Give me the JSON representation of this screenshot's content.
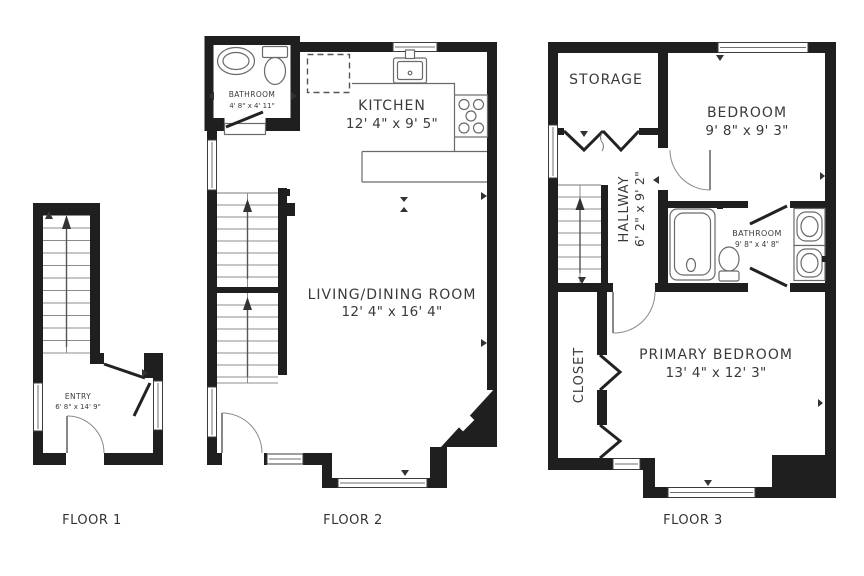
{
  "palette": {
    "wall": "#1f1f1f",
    "fixture_line": "#6a6a6a",
    "stair_line": "#8c8c8c",
    "text": "#3a3a3a",
    "background": "#ffffff"
  },
  "floors": {
    "floor1": {
      "caption": "FLOOR 1",
      "rooms": {
        "entry": {
          "name": "ENTRY",
          "dims": "6' 8\" x 14' 9\""
        }
      }
    },
    "floor2": {
      "caption": "FLOOR 2",
      "rooms": {
        "bathroom": {
          "name": "BATHROOM",
          "dims": "4' 8\" x 4' 11\""
        },
        "kitchen": {
          "name": "KITCHEN",
          "dims": "12' 4\" x 9' 5\""
        },
        "living_dining": {
          "name": "LIVING/DINING ROOM",
          "dims": "12' 4\" x 16' 4\""
        }
      }
    },
    "floor3": {
      "caption": "FLOOR 3",
      "rooms": {
        "storage": {
          "name": "STORAGE"
        },
        "bedroom": {
          "name": "BEDROOM",
          "dims": "9' 8\" x 9' 3\""
        },
        "hallway": {
          "name": "HALLWAY",
          "dims": "6' 2\" x 9' 2\""
        },
        "bathroom": {
          "name": "BATHROOM",
          "dims": "9' 8\" x 4' 8\""
        },
        "closet": {
          "name": "CLOSET"
        },
        "primary_bedroom": {
          "name": "PRIMARY BEDROOM",
          "dims": "13' 4\" x 12' 3\""
        }
      }
    }
  }
}
